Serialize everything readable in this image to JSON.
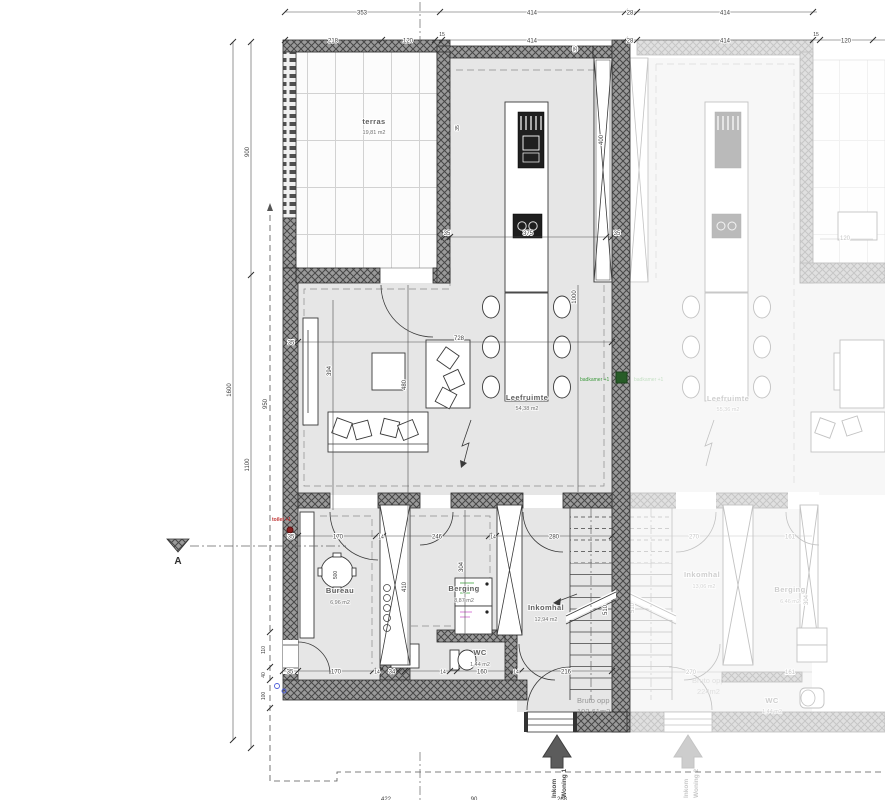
{
  "drawing": {
    "section_marker": "A",
    "unit1": {
      "rooms": {
        "terras": {
          "name": "terras",
          "area": "19,81 m2"
        },
        "leefruimte": {
          "name": "Leefruimte",
          "area": "54,38 m2"
        },
        "bureau": {
          "name": "Bureau",
          "area": "6,96 m2"
        },
        "berging": {
          "name": "Berging",
          "area": "8,87 m2"
        },
        "inkomhal": {
          "name": "Inkomhal",
          "area": "12,94 m2"
        },
        "wc": {
          "name": "WC",
          "area": "1,44 m2"
        }
      },
      "bruto": {
        "label": "Bruto opp :",
        "value": "192,61m2"
      },
      "entry": {
        "line1": "Inkom",
        "line2": "Woning 1"
      },
      "notes": {
        "toilet": "toilet +1",
        "badkamer": "badkamer +1"
      }
    },
    "unit2": {
      "rooms": {
        "leefruimte": {
          "name": "Leefruimte",
          "area": "55,36 m2"
        },
        "inkomhal": {
          "name": "Inkomhal",
          "area": "13,06 m2"
        },
        "berging": {
          "name": "Berging",
          "area": "6,46 m2"
        },
        "wc": {
          "name": "WC",
          "area": "1,44 m2"
        }
      },
      "bruto": {
        "label": "Bruto opp",
        "value": "224m2"
      },
      "entry": {
        "line1": "Inkom",
        "line2": "Woning 2"
      },
      "notes": {
        "badkamer": "badkamer +1"
      }
    },
    "dims": {
      "top1": [
        "353",
        "414",
        "28",
        "414"
      ],
      "top2": [
        "218",
        "120",
        "15",
        "414",
        "28",
        "414",
        "15",
        "120"
      ],
      "left": {
        "v900": "900",
        "v1600": "1600",
        "v1100": "1100",
        "v950": "950",
        "v110": "110",
        "v40": "40",
        "v100": "100"
      },
      "living": {
        "w35a": "35",
        "w728": "728",
        "h394": "394",
        "h480": "480",
        "h1000": "1000",
        "kw35l": "35",
        "kw375": "375",
        "kw35r": "35",
        "win400": "400",
        "t35a": "35",
        "t35b": "35"
      },
      "hall_top": [
        "35",
        "170",
        "14",
        "246",
        "14",
        "280"
      ],
      "hall_bottom": [
        "35",
        "170",
        "14",
        "34",
        "14",
        "160",
        "14",
        "216"
      ],
      "stairs510": "510",
      "panel410": "410",
      "v304": "304",
      "table500": "500",
      "bottom_cut": [
        "422",
        "90",
        "268"
      ],
      "u2": {
        "top0": "270",
        "top1": "161",
        "bot0": "270",
        "bot1": "161",
        "stairs": "510",
        "v304": "304",
        "terras120": "120"
      }
    }
  }
}
